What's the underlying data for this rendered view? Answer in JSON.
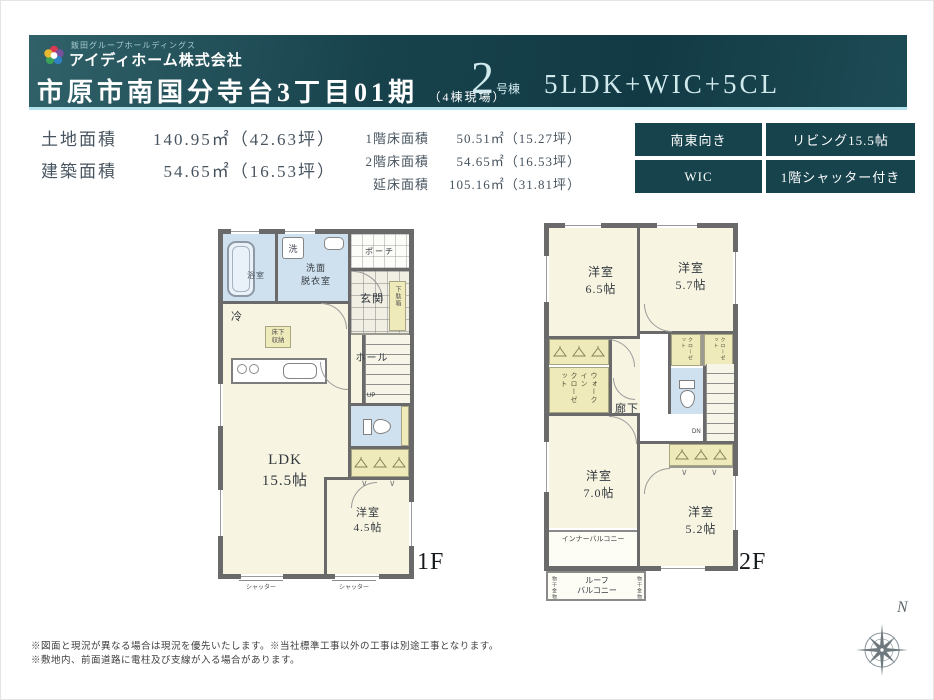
{
  "header": {
    "group_name": "飯田グループホールディングス",
    "company_name": "アイディホーム株式会社",
    "property_title": "市原市南国分寺台3丁目01期",
    "property_note": "（4棟現場）",
    "unit_number": "2",
    "unit_suffix": "号棟",
    "plan_type": "5LDK+WIC+5CL"
  },
  "areas": {
    "rows_left": [
      {
        "label": "土地面積",
        "value": "140.95㎡（42.63坪）"
      },
      {
        "label": "建築面積",
        "value": "54.65㎡（16.53坪）"
      }
    ],
    "rows_right": [
      {
        "label": "1階床面積",
        "value": "50.51㎡（15.27坪）"
      },
      {
        "label": "2階床面積",
        "value": "54.65㎡（16.53坪）"
      },
      {
        "label": "延床面積",
        "value": "105.16㎡（31.81坪）"
      }
    ]
  },
  "badges": [
    "南東向き",
    "リビング15.5帖",
    "WIC",
    "1階シャッター付き"
  ],
  "floor1": {
    "floor_label": "1F",
    "ldk": "LDK\n15.5帖",
    "bedroom": "洋室\n4.5帖",
    "bath": "浴室",
    "washroom": "洗面\n脱衣室",
    "washer": "洗",
    "porch": "ポーチ",
    "genkan": "玄関",
    "shoe_cabinet": "下駄箱",
    "hall": "ホール",
    "up": "UP",
    "fridge": "冷",
    "floor_storage": "床下\n収納",
    "shutter": "シャッター"
  },
  "floor2": {
    "floor_label": "2F",
    "bedroom_65": "洋室\n6.5帖",
    "bedroom_57": "洋室\n5.7帖",
    "bedroom_70": "洋室\n7.0帖",
    "bedroom_52": "洋室\n5.2帖",
    "wic": "ウォークイン\nクローゼット",
    "closet": "クローゼット",
    "hallway": "廊下",
    "dn": "DN",
    "inner_balcony": "インナーバルコニー",
    "roof_balcony": "ルーフ\nバルコニー",
    "laundry": "物干金物"
  },
  "notes": [
    "※図面と現況が異なる場合は現況を優先いたします。※当社標準工事以外の工事は別途工事となります。",
    "※敷地内、前面道路に電柱及び支線が入る場合があります。"
  ],
  "compass": {
    "north_label": "N"
  },
  "colors": {
    "header_teal": "#17424c",
    "badge_teal": "#17434c",
    "header_underline": "#b5e3ed",
    "room_cream": "#f7f4e1",
    "wet_blue": "#cfe0ee",
    "closet_yellow": "#efeaba",
    "wall_gray": "#6a6a6a"
  }
}
